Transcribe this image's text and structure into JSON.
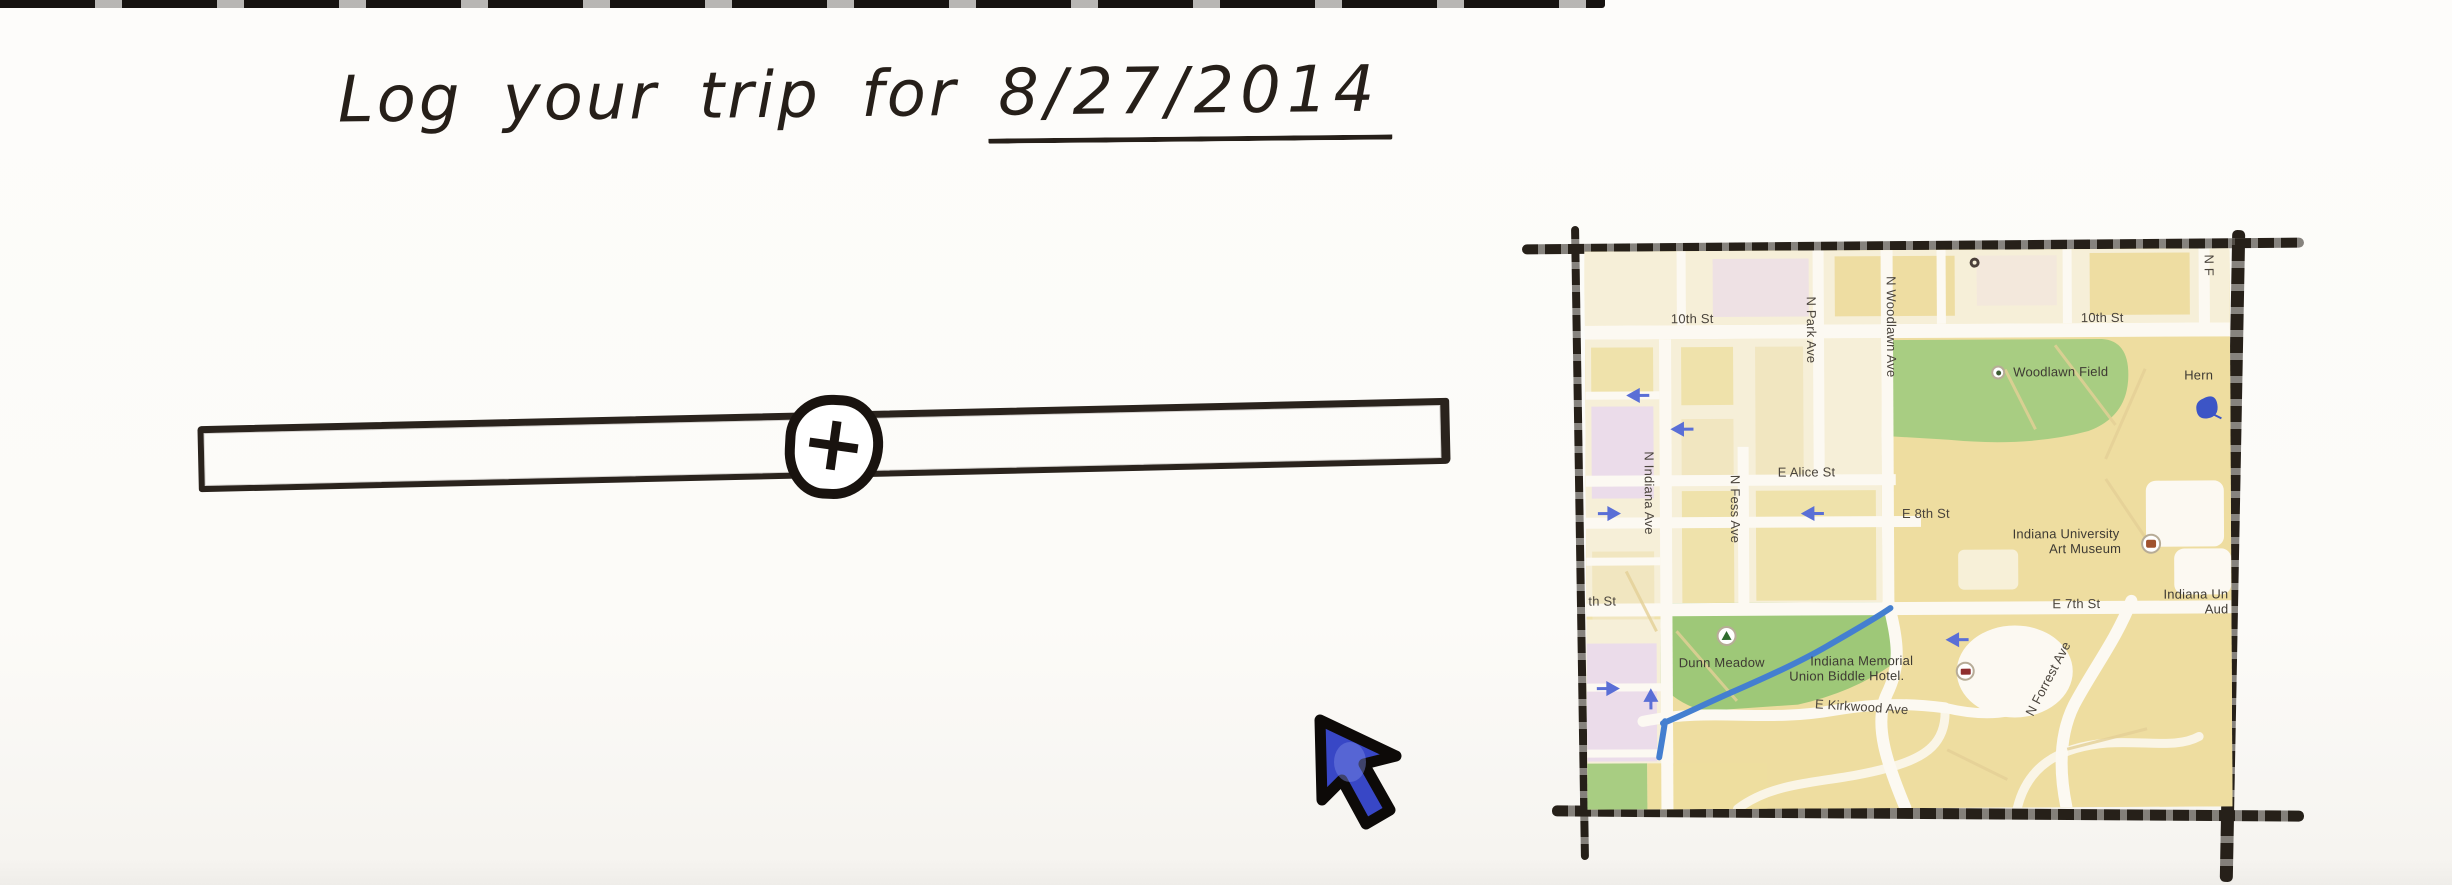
{
  "colors": {
    "paper": "#fcfbf8",
    "ink": "#261f19",
    "photo_edge": "#171310",
    "frame": "#262019",
    "cursor_blue": "#3847c6",
    "map_base": "#f0e3ad",
    "map_campus": "#eedda0",
    "map_pale": "#f6efd8",
    "map_green": "#a8cd82",
    "map_meadow": "#9ec878",
    "map_pink": "#ebdcea",
    "street": "#fcf9f2",
    "map_faint": "#e3cf96",
    "creek": "#447fd0",
    "arrow_blue": "#5a6fd6",
    "label": "#4a443c",
    "marker_brown": "#a0522d",
    "marker_red": "#8f2f2f",
    "pin_blue": "#3c55c6"
  },
  "header": {
    "title_prefix": "Log your trip for",
    "date": "8/27/2014"
  },
  "timeline": {
    "add_button_glyph": "+"
  },
  "icons": {
    "add_button": "plus-in-circle",
    "cursor": "nw-arrow-pointer",
    "woodlawn_marker": "dot-poi-marker",
    "dunn_marker": "tree-poi-marker",
    "museum_marker": "museum-poi-marker",
    "hotel_marker": "lodging-poi-marker",
    "pin": "blue-map-pin",
    "one_way": "one-way-arrow"
  },
  "map": {
    "streets": {
      "tenth_st_left": "10th St",
      "tenth_st_right": "10th St",
      "n_park_ave": "N Park Ave",
      "n_woodlawn_ave": "N Woodlawn Ave",
      "n_f_edge": "N F",
      "e_alice_st": "E Alice St",
      "n_indiana_ave": "N Indiana Ave",
      "n_fess_ave": "N Fess Ave",
      "e_8th_st": "E 8th St",
      "e_7th_st": "E 7th St",
      "seventh_st_edge": "th St",
      "e_kirkwood_ave": "E Kirkwood Ave",
      "n_forrest_ave": "N Forrest Ave"
    },
    "pois": {
      "woodlawn_field": "Woodlawn Field",
      "herman_edge": "Hern",
      "art_museum_line1": "Indiana University",
      "art_museum_line2": "Art Museum",
      "indiana_un_edge_line1": "Indiana Un",
      "indiana_un_edge_line2": "Aud",
      "dunn_meadow": "Dunn Meadow",
      "imu_line1": "Indiana Memorial",
      "imu_line2": "Union Biddle Hotel."
    }
  }
}
